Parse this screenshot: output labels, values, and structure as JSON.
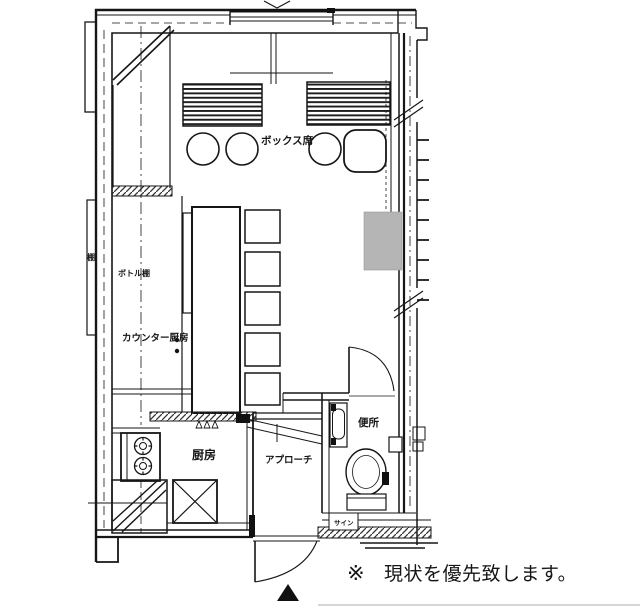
{
  "labels": {
    "box_seats": "ボックス席",
    "bottle_shelf": "ボトル棚",
    "counter_kitchen": "カウンター厨房",
    "kitchen": "厨房",
    "approach": "アプローチ",
    "toilet": "便所",
    "sign": "サイン",
    "shelf": "棚"
  },
  "note": {
    "prefix": "※",
    "text": "現状を優先致します。",
    "color": "#cc3333"
  },
  "colors": {
    "line": "#161616",
    "gray_fixture": "#b5b5b5",
    "background": "#ffffff"
  }
}
